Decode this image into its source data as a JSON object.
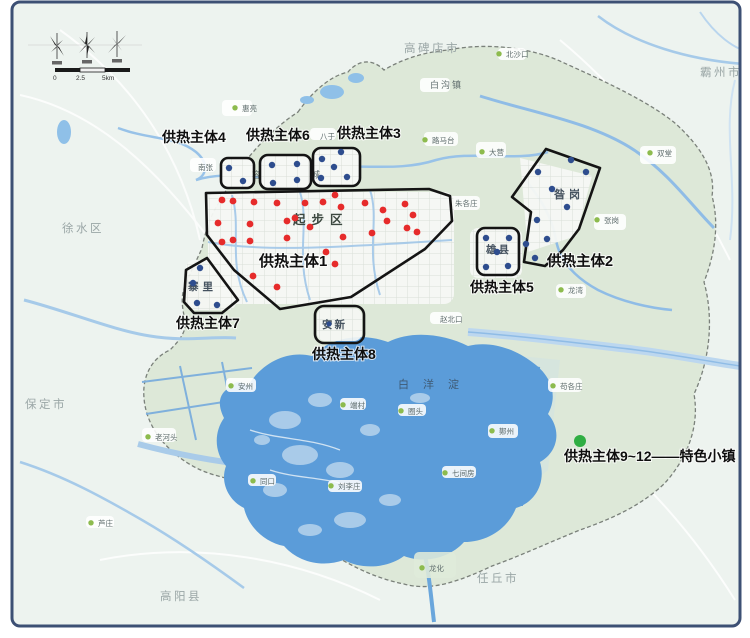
{
  "map": {
    "colors": {
      "frame": "#3d5074",
      "outside_bg": "#edf3ef",
      "region_fill": "#dde8d8",
      "lake": "#5b9cd9",
      "red_dot": "#e62b2b",
      "blue_dot": "#2e4d8e",
      "place_dot": "#8dbb4e",
      "town_green_dot": "#2fae43"
    },
    "compass": {
      "scale": [
        "0",
        "2.5",
        "5km"
      ]
    },
    "zones": [
      {
        "label": "供热主体1",
        "dot_color": "#e62b2b",
        "dot_radius": 3.4,
        "label_x": 259,
        "label_y": 266,
        "font_size": 15,
        "dots": [
          [
            222,
            200
          ],
          [
            233,
            201
          ],
          [
            254,
            202
          ],
          [
            277,
            203
          ],
          [
            295,
            218
          ],
          [
            305,
            203
          ],
          [
            323,
            202
          ],
          [
            335,
            195
          ],
          [
            341,
            207
          ],
          [
            365,
            203
          ],
          [
            383,
            210
          ],
          [
            387,
            221
          ],
          [
            405,
            204
          ],
          [
            413,
            215
          ],
          [
            407,
            228
          ],
          [
            417,
            232
          ],
          [
            372,
            233
          ],
          [
            343,
            237
          ],
          [
            287,
            221
          ],
          [
            250,
            224
          ],
          [
            218,
            223
          ],
          [
            222,
            242
          ],
          [
            233,
            240
          ],
          [
            250,
            241
          ],
          [
            287,
            238
          ],
          [
            310,
            227
          ],
          [
            335,
            264
          ],
          [
            253,
            276
          ],
          [
            277,
            287
          ],
          [
            326,
            252
          ]
        ]
      },
      {
        "label": "供热主体2",
        "dot_color": "#2e4d8e",
        "dot_radius": 3.2,
        "label_x": 547,
        "label_y": 266,
        "font_size": 14.5,
        "dots": [
          [
            571,
            160
          ],
          [
            586,
            172
          ],
          [
            538,
            172
          ],
          [
            552,
            189
          ],
          [
            567,
            207
          ],
          [
            537,
            220
          ],
          [
            547,
            239
          ],
          [
            526,
            244
          ],
          [
            535,
            258
          ]
        ]
      },
      {
        "label": "供热主体3",
        "dot_color": "#2e4d8e",
        "dot_radius": 3.2,
        "label_x": 337,
        "label_y": 138,
        "font_size": 14,
        "dots": [
          [
            322,
            159
          ],
          [
            341,
            152
          ],
          [
            334,
            167
          ],
          [
            321,
            178
          ],
          [
            347,
            177
          ]
        ]
      },
      {
        "label": "供热主体4",
        "dot_color": "#2e4d8e",
        "dot_radius": 3.2,
        "label_x": 162,
        "label_y": 142,
        "font_size": 14,
        "dots": [
          [
            229,
            168
          ],
          [
            243,
            181
          ]
        ]
      },
      {
        "label": "供热主体5",
        "dot_color": "#2e4d8e",
        "dot_radius": 3.2,
        "label_x": 470,
        "label_y": 292,
        "font_size": 14,
        "dots": [
          [
            486,
            238
          ],
          [
            509,
            238
          ],
          [
            497,
            252
          ],
          [
            486,
            267
          ],
          [
            508,
            266
          ]
        ]
      },
      {
        "label": "供热主体6",
        "dot_color": "#2e4d8e",
        "dot_radius": 3.2,
        "label_x": 246,
        "label_y": 140,
        "font_size": 14,
        "dots": [
          [
            272,
            165
          ],
          [
            297,
            164
          ],
          [
            273,
            183
          ],
          [
            297,
            180
          ]
        ]
      },
      {
        "label": "供热主体7",
        "dot_color": "#2e4d8e",
        "dot_radius": 3.2,
        "label_x": 176,
        "label_y": 328,
        "font_size": 14,
        "dots": [
          [
            200,
            268
          ],
          [
            193,
            283
          ],
          [
            197,
            303
          ],
          [
            217,
            305
          ]
        ]
      },
      {
        "label": "供热主体8",
        "dot_color": "#2e4d8e",
        "dot_radius": 2.6,
        "label_x": 312,
        "label_y": 359,
        "font_size": 14,
        "dots": [
          [
            329,
            324
          ]
        ]
      },
      {
        "label": "供热主体9~12——特色小镇",
        "dot_color": "#2fae43",
        "dot_radius": 6,
        "label_x": 564,
        "label_y": 461,
        "font_size": 14,
        "dots": [
          [
            580,
            441
          ]
        ]
      }
    ],
    "area_labels": [
      {
        "text": "起步区",
        "x": 293,
        "y": 224,
        "size": 12.5,
        "ls": 6,
        "color": "#3c4840",
        "weight": 600
      },
      {
        "text": "白洋淀",
        "x": 398,
        "y": 388,
        "size": 11,
        "ls": 14,
        "color": "#3f5a74",
        "weight": 500
      },
      {
        "text": "昝岗",
        "x": 554,
        "y": 198,
        "size": 11,
        "ls": 4,
        "color": "#45525f",
        "weight": 600
      },
      {
        "text": "雄县",
        "x": 486,
        "y": 253,
        "size": 10.5,
        "ls": 2,
        "color": "#45525f",
        "weight": 600
      },
      {
        "text": "寨里",
        "x": 188,
        "y": 290,
        "size": 10.5,
        "ls": 4,
        "color": "#45525f",
        "weight": 600
      },
      {
        "text": "安新",
        "x": 322,
        "y": 328,
        "size": 10.5,
        "ls": 2,
        "color": "#45525f",
        "weight": 600
      }
    ],
    "cities": [
      {
        "name": "高碑店市",
        "x": 404,
        "y": 52
      },
      {
        "name": "霸州市",
        "x": 700,
        "y": 76
      },
      {
        "name": "徐水区",
        "x": 62,
        "y": 232
      },
      {
        "name": "保定市",
        "x": 25,
        "y": 408
      },
      {
        "name": "高阳县",
        "x": 160,
        "y": 600
      },
      {
        "name": "任丘市",
        "x": 477,
        "y": 582
      }
    ],
    "places": [
      {
        "name": "白沟镇",
        "x": 430,
        "y": 88,
        "size": 9,
        "color": "#9aa6a6",
        "ls": 2
      },
      {
        "name": "北沙口",
        "x": 506,
        "y": 57,
        "dot": true
      },
      {
        "name": "惠亮",
        "x": 242,
        "y": 111,
        "dot": true
      },
      {
        "name": "南张",
        "x": 198,
        "y": 170
      },
      {
        "name": "容城",
        "x": 252,
        "y": 178,
        "size": 9,
        "ls": 50
      },
      {
        "name": "八于",
        "x": 320,
        "y": 139
      },
      {
        "name": "路马台",
        "x": 432,
        "y": 143,
        "dot": true
      },
      {
        "name": "大营",
        "x": 489,
        "y": 155,
        "dot": true
      },
      {
        "name": "双堂",
        "x": 657,
        "y": 156,
        "dot": true
      },
      {
        "name": "张岗",
        "x": 604,
        "y": 223,
        "dot": true
      },
      {
        "name": "朱各庄",
        "x": 455,
        "y": 206
      },
      {
        "name": "龙湾",
        "x": 568,
        "y": 293,
        "dot": true
      },
      {
        "name": "赵北口",
        "x": 440,
        "y": 322
      },
      {
        "name": "苟各庄",
        "x": 560,
        "y": 389,
        "dot": true
      },
      {
        "name": "鄚州",
        "x": 499,
        "y": 434,
        "dot": true
      },
      {
        "name": "七间房",
        "x": 452,
        "y": 476,
        "dot": true
      },
      {
        "name": "圈头",
        "x": 408,
        "y": 414,
        "dot": true
      },
      {
        "name": "端村",
        "x": 350,
        "y": 408,
        "dot": true
      },
      {
        "name": "刘李庄",
        "x": 338,
        "y": 489,
        "dot": true
      },
      {
        "name": "安州",
        "x": 238,
        "y": 389,
        "dot": true
      },
      {
        "name": "老河头",
        "x": 155,
        "y": 440,
        "dot": true
      },
      {
        "name": "同口",
        "x": 260,
        "y": 484,
        "dot": true
      },
      {
        "name": "龙化",
        "x": 429,
        "y": 571,
        "dot": true
      },
      {
        "name": "芦庄",
        "x": 98,
        "y": 526,
        "dot": true
      }
    ]
  }
}
